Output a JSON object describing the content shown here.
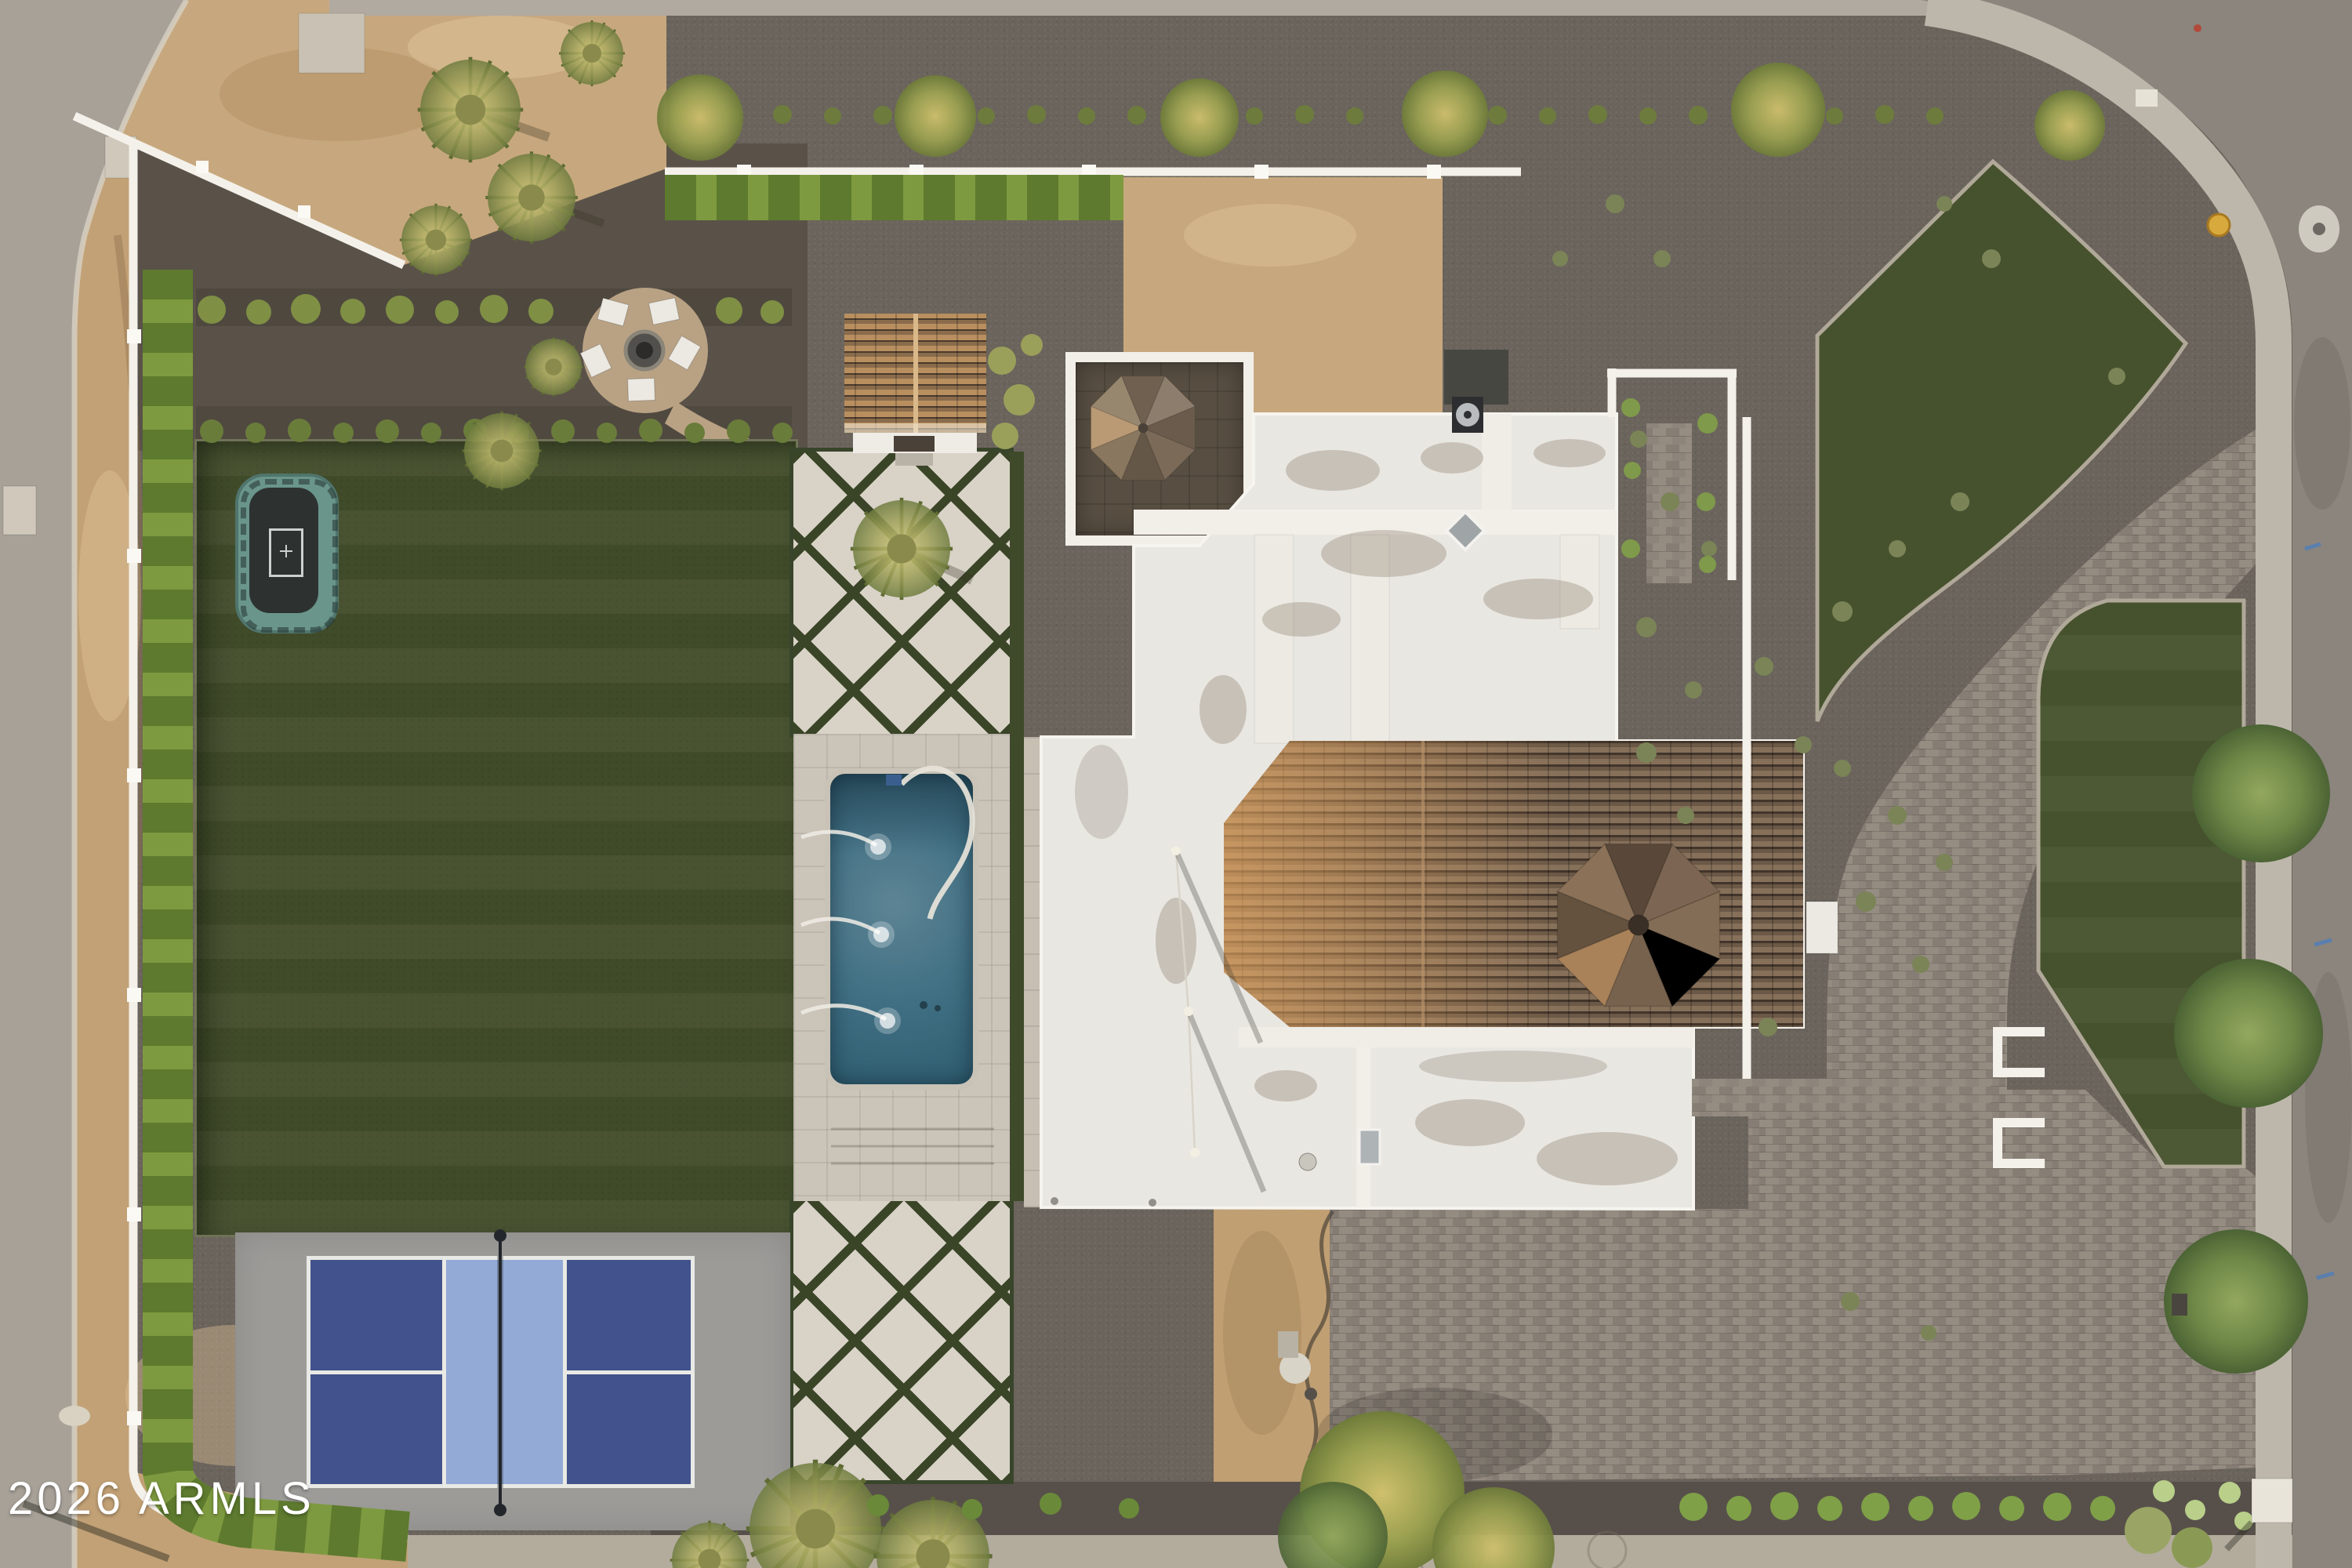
{
  "watermark": {
    "text": "2026 ARMLS",
    "color": "#ffffff"
  },
  "scene": {
    "description": "Aerial drone photo of a modern desert estate at dusk",
    "features": [
      "flat-white-roof-house",
      "clay-tile-roof",
      "octagonal-turret-roof",
      "rectangular-pool",
      "pool-fountain-jets",
      "pool-cleaner-hose",
      "artificial-turf-lawn",
      "in-ground-trampoline",
      "pickleball-court",
      "diamond-lattice-pavers",
      "fire-pit-patio-circle",
      "casita-tile-roof",
      "patio-umbrella",
      "paver-driveway",
      "motor-court",
      "white-garden-walls",
      "boundary-hedge",
      "desert-gravel-landscaping",
      "palm-trees",
      "street",
      "sidewalk",
      "mailbox",
      "fire-hydrant",
      "manhole-cover"
    ],
    "colors": {
      "turf": "#43502c",
      "pool_water": "#3c6474",
      "court_dark_blue": "#42528c",
      "court_light_blue": "#93a9d6",
      "tile_roof": "#74604d",
      "white_roof": "#e9e7e2",
      "gravel": "#6b645c",
      "dirt": "#c7a87e",
      "driveway_paver": "#8d847b",
      "hedge": "#7e9a40"
    }
  }
}
